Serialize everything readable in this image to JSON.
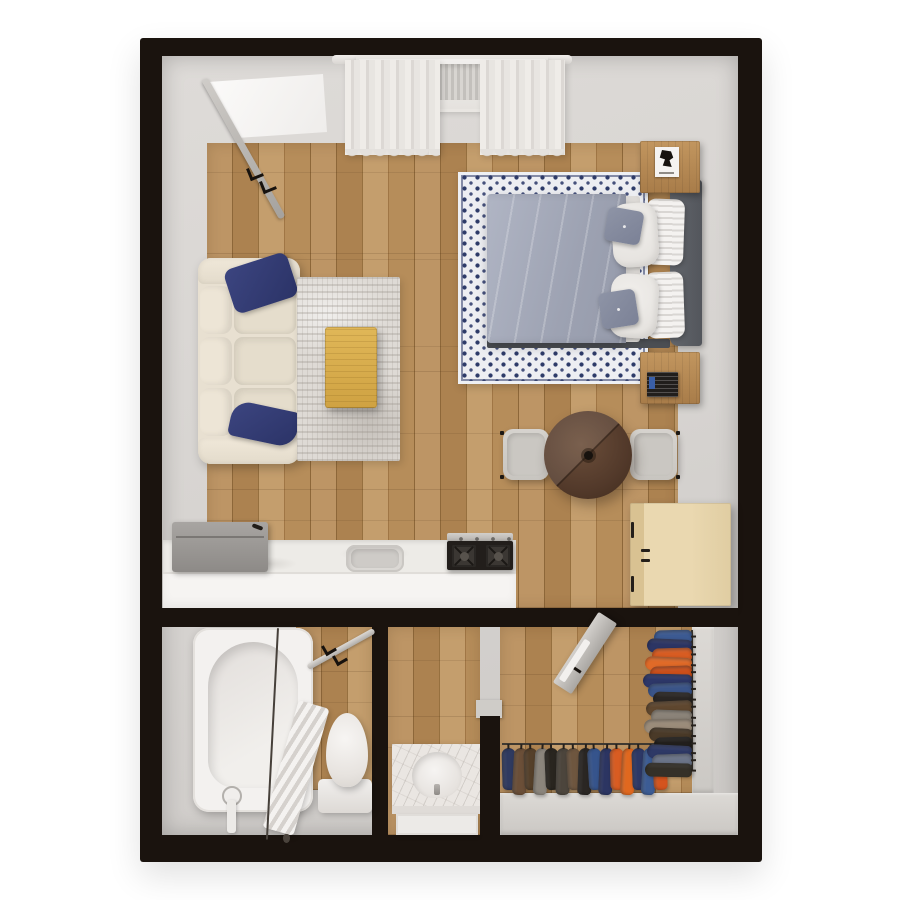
{
  "scene": {
    "kind": "3d-floor-plan-top-view",
    "subject": "studio-apartment"
  },
  "palette": {
    "wall": "#1a130e",
    "margin": "#d6d3d0",
    "wood": "#b28a57",
    "rug-navy": "#2b3367",
    "duvet": "#a3a8b8",
    "sofa-cream": "#e8e0d1",
    "coffee-oak": "#d9ae4e",
    "walnut": "#52392a",
    "beech": "#e6d2aa",
    "fixture-white": "#f4f2f0"
  },
  "closet": {
    "bottom_rack": [
      "#2f3a60",
      "#6b4f38",
      "#55402a",
      "#8b857c",
      "#29251f",
      "#4c453c",
      "#6e563f",
      "#2a2623",
      "#36548c",
      "#2c3562",
      "#d85c22",
      "#e0681f",
      "#2d3866",
      "#3c5c94",
      "#d4541e"
    ],
    "right_rack": [
      "#3c5a92",
      "#2c3564",
      "#d85c22",
      "#e06a28",
      "#cc4f1a",
      "#2d3768",
      "#3a5488",
      "#2a2623",
      "#5f472f",
      "#8b8378",
      "#9b8c7a",
      "#4a3a28",
      "#221f1c",
      "#2e3966",
      "#6b7488",
      "#343028"
    ]
  }
}
